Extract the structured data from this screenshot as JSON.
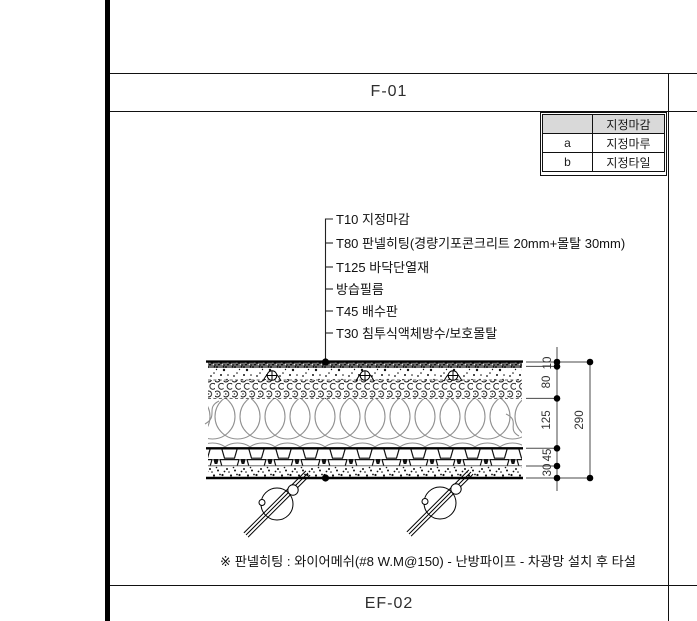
{
  "top_band": {
    "label": "F-01"
  },
  "bottom_band": {
    "label": "EF-02"
  },
  "finish_table": {
    "header_label": "지정마감",
    "rows": [
      {
        "key": "a",
        "finish": "지정마루"
      },
      {
        "key": "b",
        "finish": "지정타일"
      }
    ]
  },
  "callouts": {
    "items": [
      "T10 지정마감",
      "T80 판넬히팅(경량기포콘크리트 20mm+몰탈 30mm)",
      "T125 바닥단열재",
      "방습필름",
      "T45 배수판",
      "T30 침투식액체방수/보호몰탈"
    ]
  },
  "dimensions": {
    "layer_thicknesses": [
      "10",
      "80",
      "125",
      "45",
      "30"
    ],
    "total": "290"
  },
  "footnote": {
    "text": "※ 판넬히팅 : 와이어메쉬(#8 W.M@150) - 난방파이프 - 차광망 설치 후 타설"
  },
  "colors": {
    "line": "#111111",
    "dim_line": "#444444",
    "table_header_bg": "#d9d9d9",
    "insulation_stroke": "#909090"
  }
}
